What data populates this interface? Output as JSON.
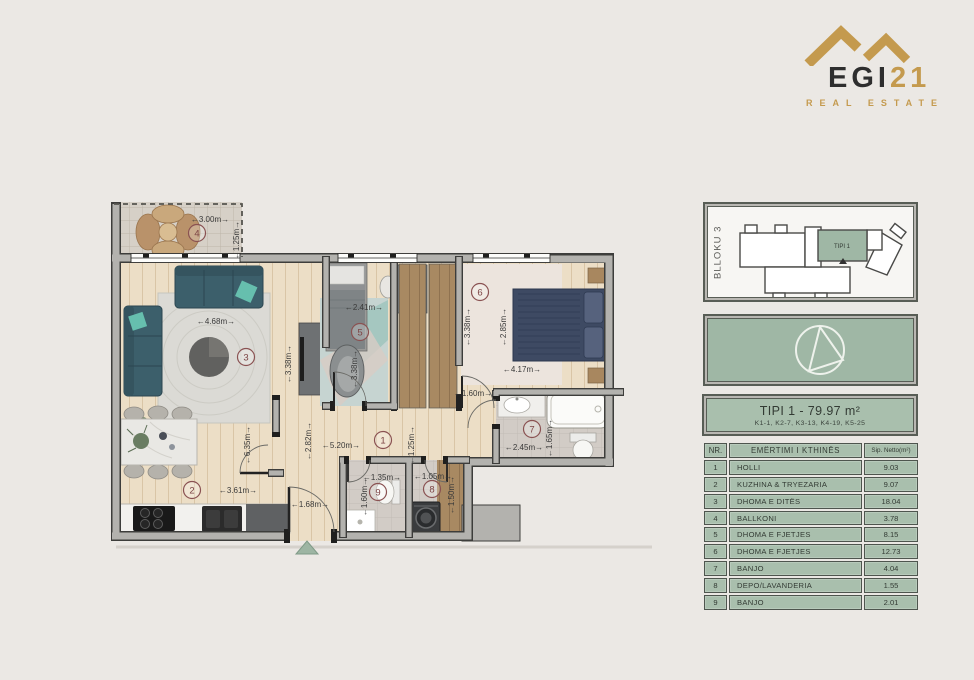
{
  "logo": {
    "brand_dark": "EGI",
    "brand_gold": "21",
    "tagline": "REAL ESTATE",
    "gold": "#c49a4e"
  },
  "panel": {
    "block_label": "BLLOKU 3",
    "block_unit": "TIPI 1",
    "title": "TIPI 1 - 79.97 m²",
    "subtitle": "K1-1, K2-7, K3-13, K4-19, K5-25",
    "accent_green": "#a9bfad",
    "table": {
      "headers": {
        "nr": "NR.",
        "name": "EMËRTIMI I KTHINËS",
        "area": "Sip. Netto(m²)"
      },
      "rows": [
        {
          "nr": "1",
          "name": "HOLLI",
          "area": "9.03"
        },
        {
          "nr": "2",
          "name": "KUZHINA & TRYEZARIA",
          "area": "9.07"
        },
        {
          "nr": "3",
          "name": "DHOMA E DITËS",
          "area": "18.04"
        },
        {
          "nr": "4",
          "name": "BALLKONI",
          "area": "3.78"
        },
        {
          "nr": "5",
          "name": "DHOMA E FJETJES",
          "area": "8.15"
        },
        {
          "nr": "6",
          "name": "DHOMA E FJETJES",
          "area": "12.73"
        },
        {
          "nr": "7",
          "name": "BANJO",
          "area": "4.04"
        },
        {
          "nr": "8",
          "name": "DEPO/LAVANDERIA",
          "area": "1.55"
        },
        {
          "nr": "9",
          "name": "BANJO",
          "area": "2.01"
        }
      ]
    }
  },
  "plan": {
    "rooms": {
      "r1": "1",
      "r2": "2",
      "r3": "3",
      "r4": "4",
      "r5": "5",
      "r6": "6",
      "r7": "7",
      "r8": "8",
      "r9": "9"
    },
    "dims": {
      "balcony_w": "←3.00m→",
      "balcony_h": "←1.25m→",
      "living_w": "←4.68m→",
      "living_h": "←3.38m→",
      "room5_w": "←2.41m→",
      "room5_h": "←3.38m→",
      "room6_h_left": "←3.38m→",
      "room6_h_right": "←2.85m→",
      "room6_w": "←4.17m→",
      "bath_entry": "←1.60m→",
      "bath_w": "←2.45m→",
      "bath_h": "←1.65m→",
      "kitchen_h": "←6.35m→",
      "hall_h2": "←2.82m→",
      "hall_w": "←5.20m→",
      "hall_h": "←1.25m→",
      "kitchen_w": "←3.61m→",
      "entry_w": "←1.68m→",
      "wc9_w": "←1.35m→",
      "wc9_h": "←1.60m→",
      "dep8_w": "←1.05m→",
      "dep8_h": "←1.50m→"
    }
  }
}
